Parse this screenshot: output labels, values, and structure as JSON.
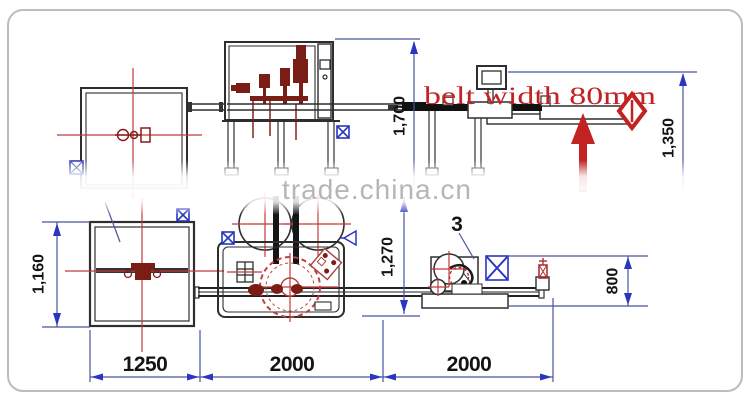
{
  "diagram": {
    "title_watermark": "trade.china.cn",
    "annotations": {
      "belt_width_label": "belt width 80mm",
      "part_number_label": "3"
    },
    "dimensions": {
      "filler_overall_height": "1,700",
      "outfeed_table_height": "1,350",
      "infeed_hopper_width": "1,160",
      "center_section_height": "1,270",
      "labeler_section_width": "800",
      "bottom_chain": [
        "1250",
        "2000",
        "2000"
      ]
    },
    "colors": {
      "dimension_line": "#4a549e",
      "dimension_arrow": "#2a35c0",
      "machine_outline": "#2e2e2e",
      "centerline_red": "#c03a3a",
      "component_dark_red": "#7a1d15",
      "annotation_red": "#c32222",
      "watermark_gray": "#b6b6b6",
      "frame_border": "#bcbcbc"
    }
  }
}
